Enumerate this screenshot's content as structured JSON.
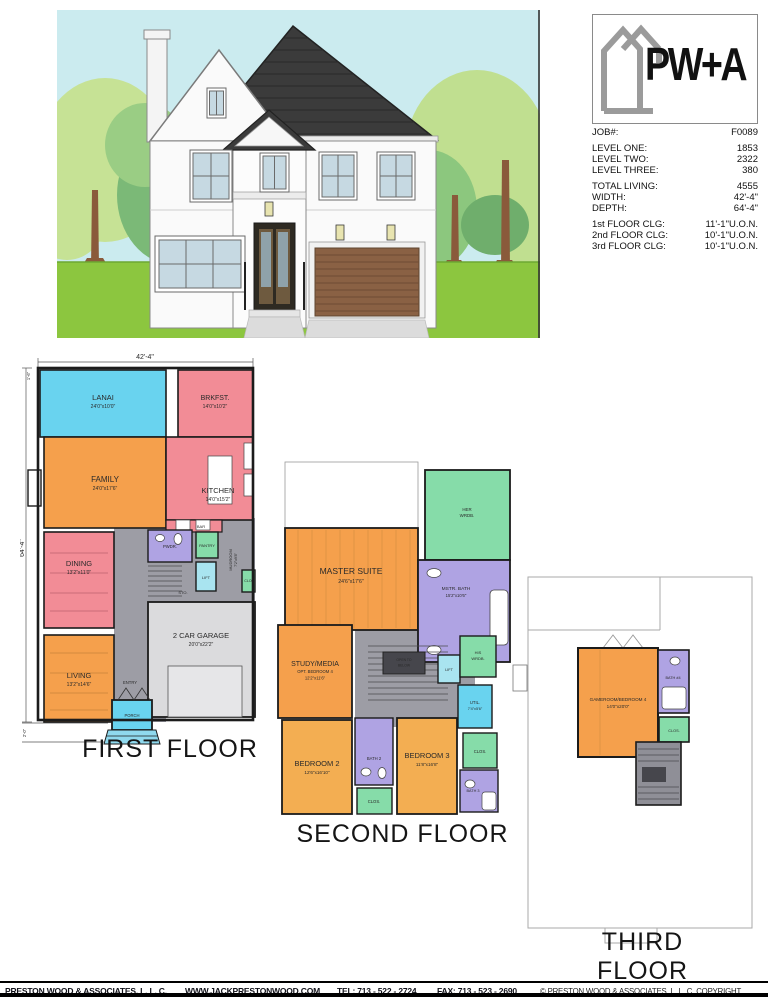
{
  "logo": {
    "text": "PW+A"
  },
  "job_info": {
    "rows": [
      {
        "label": "JOB#:",
        "value": "F0089"
      },
      {
        "label": "LEVEL ONE:",
        "value": "1853"
      },
      {
        "label": "LEVEL TWO:",
        "value": "2322"
      },
      {
        "label": "LEVEL THREE:",
        "value": "380"
      },
      {
        "label": "TOTAL LIVING:",
        "value": "4555"
      },
      {
        "label": "WIDTH:",
        "value": "42'-4\""
      },
      {
        "label": "DEPTH:",
        "value": "64'-4\""
      },
      {
        "label": "1st FLOOR CLG:",
        "value": "11'-1\"U.O.N."
      },
      {
        "label": "2nd FLOOR CLG:",
        "value": "10'-1\"U.O.N."
      },
      {
        "label": "3rd FLOOR CLG:",
        "value": "10'-1\"U.O.N."
      }
    ]
  },
  "floors": {
    "first": {
      "title": "FIRST FLOOR",
      "dims": {
        "width": "42'-4\"",
        "height": "64'-4\"",
        "top_small": "1'-6\"",
        "bottom_small": "2'-0\""
      },
      "rooms": {
        "lanai": {
          "name": "LANAI",
          "size": "24'0\"x10'0\""
        },
        "brkfst": {
          "name": "BRKFST.",
          "size": "14'0\"x10'2\""
        },
        "family": {
          "name": "FAMILY",
          "size": "24'0\"x17'6\""
        },
        "kitchen": {
          "name": "KITCHEN",
          "size": "14'0\"x15'2\""
        },
        "dining": {
          "name": "DINING",
          "size": "13'2\"x11'0\""
        },
        "living": {
          "name": "LIVING",
          "size": "13'2\"x14'6\""
        },
        "pwdr": {
          "name": "PWDR."
        },
        "pantry": {
          "name": "PANTRY"
        },
        "mudroom": {
          "name": "MUDROOM",
          "size": "7'2\"x9'8\""
        },
        "lift": {
          "name": "LIFT"
        },
        "clo": {
          "name": "CLO."
        },
        "sto": {
          "name": "STO."
        },
        "bar": {
          "name": "BAR"
        },
        "garage": {
          "name": "2 CAR GARAGE",
          "size": "20'0\"x22'2\""
        },
        "entry": {
          "name": "ENTRY"
        },
        "porch": {
          "name": "PORCH"
        }
      }
    },
    "second": {
      "title": "SECOND FLOOR",
      "rooms": {
        "master": {
          "name": "MASTER SUITE",
          "size": "24'6\"x17'6\""
        },
        "her_wrdb": {
          "line1": "HER",
          "line2": "WRDB."
        },
        "mstr_bath": {
          "name": "MSTR. BATH",
          "size": "15'2\"x10'6\""
        },
        "open_below": {
          "line1": "OPEN TO",
          "line2": "BELOW"
        },
        "lift": {
          "name": "LIFT"
        },
        "his_wrdb": {
          "line1": "HIS",
          "line2": "WRDB."
        },
        "util": {
          "name": "UTIL.",
          "size": "7'4\"x5'6\""
        },
        "study": {
          "name": "STUDY/MEDIA",
          "opt": "OPT. BEDROOM 4",
          "size": "12'2\"x11'6\""
        },
        "bedroom2": {
          "name": "BEDROOM 2",
          "size": "12'6\"x16'10\""
        },
        "bath2": {
          "name": "BATH 2"
        },
        "clos_a": {
          "name": "CLOS."
        },
        "bedroom3": {
          "name": "BEDROOM 3",
          "size": "11'8\"x16'8\""
        },
        "clos_b": {
          "name": "CLOS."
        },
        "bath3": {
          "name": "BATH 3"
        }
      }
    },
    "third": {
      "title": "THIRD FLOOR",
      "rooms": {
        "gameroom": {
          "name": "GAMEROOM/BEDROOM 4",
          "size": "14'0\"x20'0\""
        },
        "bath4": {
          "name": "BATH #4"
        },
        "clos": {
          "name": "CLOS."
        }
      }
    }
  },
  "footer": {
    "company": "PRESTON WOOD & ASSOCIATES, L. L. C.",
    "website": "WWW.JACKPRESTONWOOD.COM",
    "tel": "TEL:  713 - 522 - 2724",
    "fax": "FAX:  713 - 523 - 2690",
    "copyright": "© PRESTON WOOD & ASSOCIATES, L. L. C.  COPYRIGHT"
  },
  "colors": {
    "room_orange": "#F5A04C",
    "room_yellow": "#F3AE52",
    "room_pink": "#F28C96",
    "room_cyan": "#69D3EF",
    "room_lightcyan": "#A9E4F0",
    "room_purple": "#AFA3E3",
    "room_green": "#86DCA9",
    "hall_gray": "#9D9DA5",
    "garage_gray": "#DBDBDD",
    "wall": "#1B1B1B",
    "sky": "#CBEBEF",
    "grass": "#8CC63F",
    "roof": "#3B3B3B",
    "garage_door": "#8A6144"
  }
}
